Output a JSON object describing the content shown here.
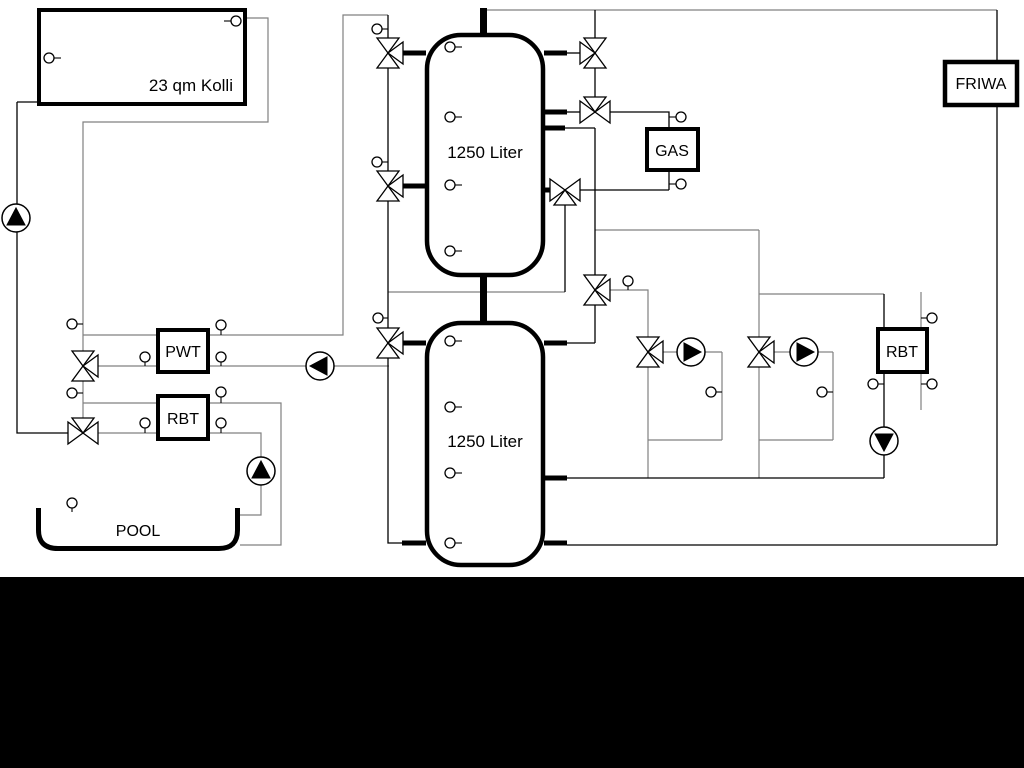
{
  "labels": {
    "collector": "23 qm Kolli",
    "tank1": "1250 Liter",
    "tank2": "1250 Liter",
    "gas": "GAS",
    "friwa": "FRIWA",
    "pwt": "PWT",
    "rbt_left": "RBT",
    "rbt_right": "RBT",
    "pool": "POOL"
  },
  "colors": {
    "pipe_gray": "#808080",
    "pipe_black": "#000000",
    "background": "#ffffff",
    "bottom_band": "#000000"
  }
}
